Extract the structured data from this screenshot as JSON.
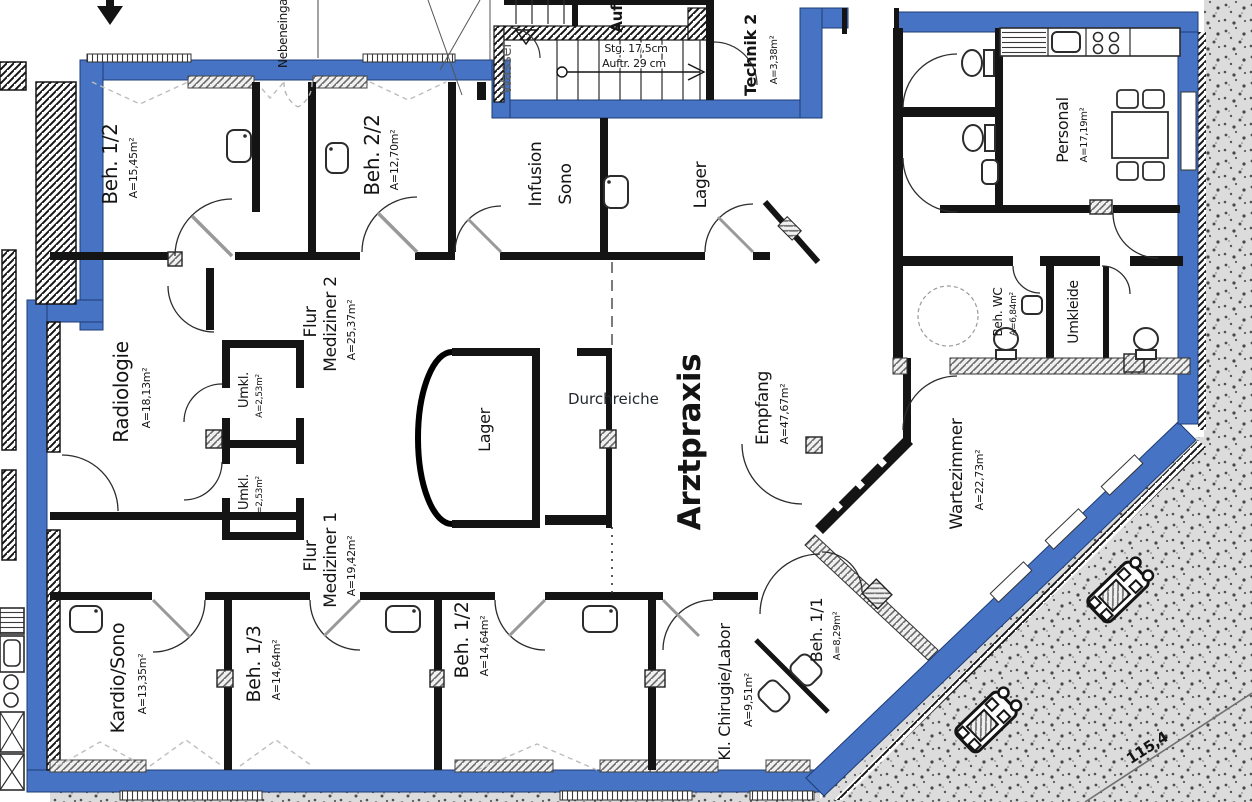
{
  "colors": {
    "wall_blue": "#4673c4",
    "wall_black": "#141414",
    "terrain_gray": "#dcdcdc",
    "annotation": "#23282e"
  },
  "rooms": {
    "beh12_top": {
      "name": "Beh. 1/2",
      "area": "A=15,45m²"
    },
    "beh22": {
      "name": "Beh. 2/2",
      "area": "A=12,70m²"
    },
    "infusion": {
      "line1": "Infusion",
      "line2": "Sono"
    },
    "lager_top": {
      "name": "Lager"
    },
    "technik": {
      "name": "Technik 2",
      "area": "A=3,38m²"
    },
    "personal": {
      "name": "Personal",
      "area": "A=17,19m²"
    },
    "umkleide": {
      "name": "Umkleide"
    },
    "beh_wc": {
      "name": "Beh. WC",
      "area": "A=6,84m²"
    },
    "wartezimmer": {
      "name": "Wartezimmer",
      "area": "A=22,73m²"
    },
    "empfang": {
      "name": "Empfang",
      "area": "A=47,67m²"
    },
    "arztpraxis": {
      "name": "Arztpraxis"
    },
    "lager_mitte": {
      "name": "Lager"
    },
    "radiologie": {
      "name": "Radiologie",
      "area": "A=18,13m²"
    },
    "umkl1": {
      "name": "Umkl.",
      "area": "A=2,53m²"
    },
    "umkl2": {
      "name": "Umkl.",
      "area": "A=2,53m²"
    },
    "flur2": {
      "line1": "Flur",
      "line2": "Mediziner 2",
      "area": "A=25,37m²"
    },
    "flur1": {
      "line1": "Flur",
      "line2": "Mediziner 1",
      "area": "A=19,42m²"
    },
    "kardio": {
      "name": "Kardio/Sono",
      "area": "A=13,35m²"
    },
    "beh13": {
      "name": "Beh. 1/3",
      "area": "A=14,64m²"
    },
    "beh12_unten": {
      "name": "Beh. 1/2",
      "area": "A=14,64m²"
    },
    "chirurgie": {
      "name": "Kl. Chirugie/Labor",
      "area": "A=9,51m²"
    },
    "beh11": {
      "name": "Beh. 1/1",
      "area": "A=8,29m²"
    }
  },
  "annotations": {
    "durchreiche": "Durchreiche",
    "wasser": "Wasser",
    "aufzug": "Aufzug",
    "nebeneingang": "Nebeneingang",
    "stairs_line1": "Stg. 17,5cm",
    "stairs_line2": "Auftr. 29 cm",
    "elevation": "115,4"
  }
}
